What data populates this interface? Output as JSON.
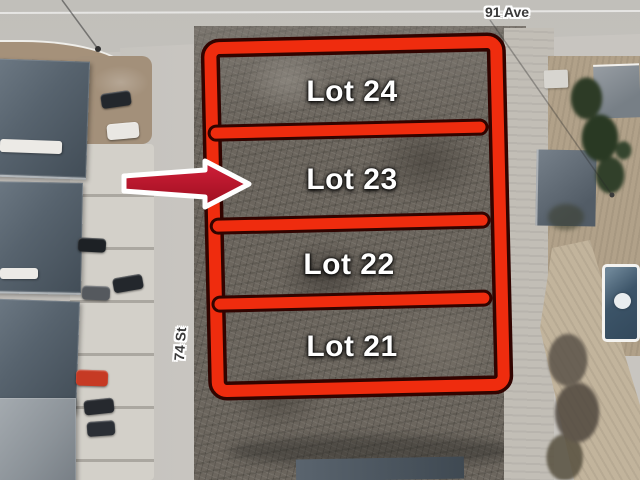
{
  "streets": {
    "avenue": "91 Ave",
    "street": "74 St"
  },
  "lots": [
    {
      "label": "Lot 24"
    },
    {
      "label": "Lot 23"
    },
    {
      "label": "Lot 22"
    },
    {
      "label": "Lot 21"
    }
  ],
  "annotation": {
    "boundary_color": "#ef2c0e",
    "boundary_outline_color": "#310400",
    "arrow_color": "#c01b2e",
    "arrow_outline_color": "#ffffff",
    "arrow_points_to": "Lot 23"
  },
  "scene_colors": {
    "road": "#c6c4bf",
    "scrub_lot": "#6c665e",
    "lawn": "#b1a189",
    "roof": "#57636e",
    "pool": "#3c5468"
  }
}
